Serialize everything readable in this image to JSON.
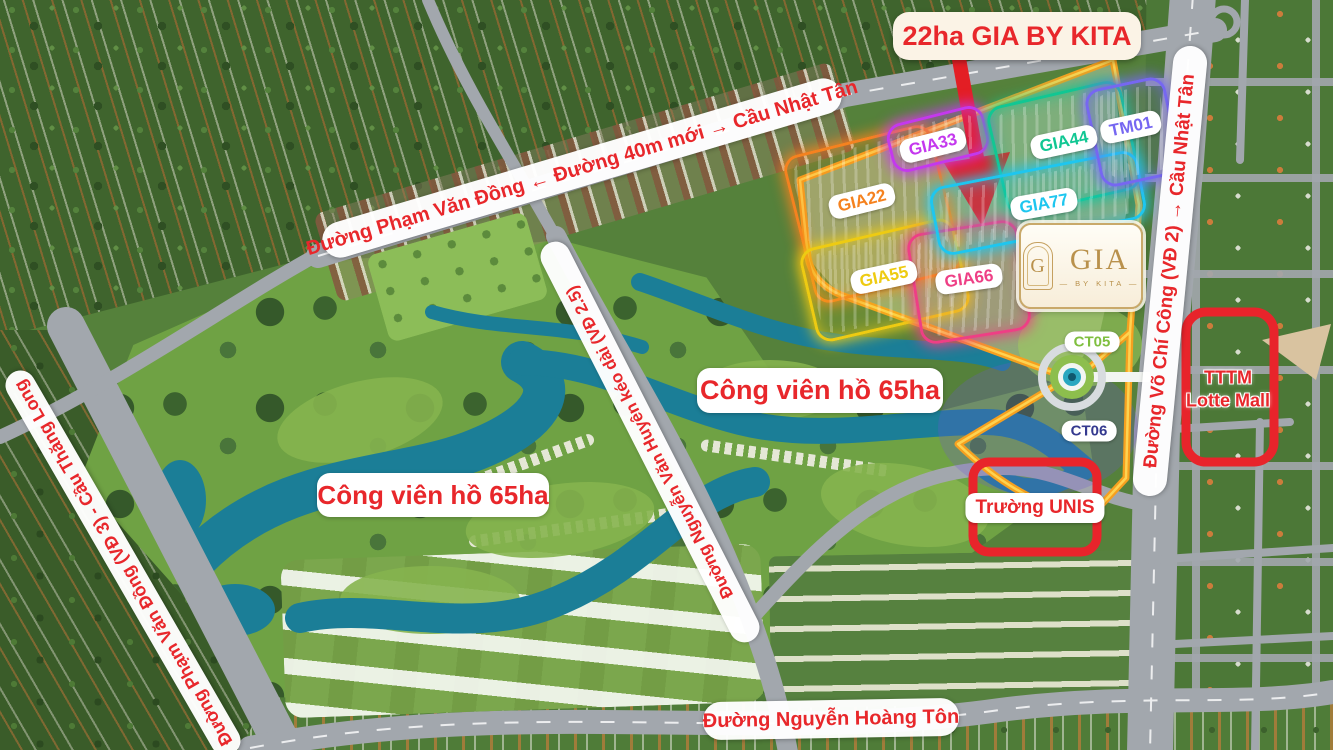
{
  "map_title": "22ha GIA BY KITA",
  "roads": {
    "top": "Đường Phạm Văn Đồng ← Đường 40m mới → Cầu Nhật Tân",
    "left": "Đường Phạm Văn Đồng (VĐ 3) - Cầu Thăng Long",
    "middle": "Đường Nguyễn Văn Huyên kéo dài (VĐ 2.5)",
    "right": "Đường Võ Chí Công (VĐ 2) → Cầu Nhật Tân",
    "bottom": "Đường Nguyễn Hoàng Tôn"
  },
  "parks": [
    "Công viên hồ 65ha",
    "Công viên hồ 65ha"
  ],
  "zones": [
    {
      "label": "GIA22",
      "color": "#F5821F"
    },
    {
      "label": "GIA33",
      "color": "#C438EE"
    },
    {
      "label": "GIA44",
      "color": "#11C793"
    },
    {
      "label": "GIA55",
      "color": "#EECB12"
    },
    {
      "label": "GIA66",
      "color": "#EE3F85"
    },
    {
      "label": "GIA77",
      "color": "#1EC6EF"
    },
    {
      "label": "TM01",
      "color": "#7667F1"
    }
  ],
  "towers": [
    {
      "label": "CT05",
      "color": "#7FBF3F"
    },
    {
      "label": "CT06",
      "color": "#34398F"
    }
  ],
  "landmarks": {
    "lotte_line1": "TTTM",
    "lotte_line2": "Lotte Mall",
    "unis": "Trường UNIS"
  },
  "logo": {
    "monogram": "G",
    "name": "GIA",
    "byline": "BY KITA"
  },
  "colors": {
    "accent_red": "#E8272B",
    "boundary_orange": "#F6A01F",
    "boundary_yellow": "#FFD957",
    "water_teal": "#1B7E97"
  }
}
